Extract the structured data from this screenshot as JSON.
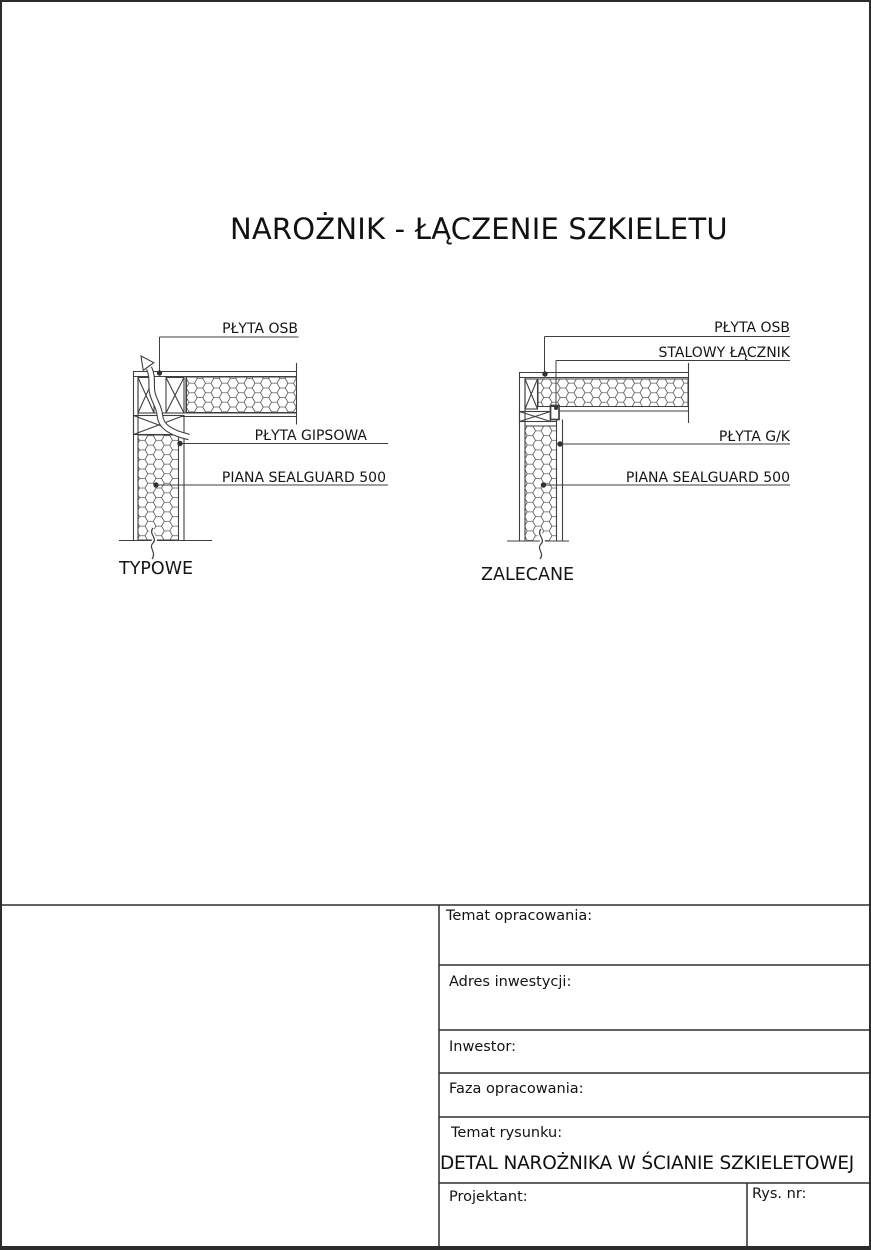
{
  "page": {
    "title": "NAROŻNIK - ŁĄCZENIE SZKIELETU"
  },
  "diagram_left": {
    "caption": "TYPOWE",
    "label_osb": "PŁYTA OSB",
    "label_gypsum": "PŁYTA GIPSOWA",
    "label_foam": "PIANA SEALGUARD 500"
  },
  "diagram_right": {
    "caption": "ZALECANE",
    "label_osb": "PŁYTA OSB",
    "label_connector": "STALOWY ŁĄCZNIK",
    "label_gk": "PŁYTA G/K",
    "label_foam": "PIANA SEALGUARD 500"
  },
  "title_block": {
    "temat_opracowania": "Temat opracowania:",
    "adres_inwestycji": "Adres inwestycji:",
    "inwestor": "Inwestor:",
    "faza_opracowania": "Faza opracowania:",
    "temat_rysunku": "Temat rysunku:",
    "drawing_title": "DETAL NAROŻNIKA W ŚCIANIE SZKIELETOWEJ",
    "projektant": "Projektant:",
    "rys_nr": "Rys. nr:"
  },
  "colors": {
    "background": "#ffffff",
    "line": "#3f3f3f",
    "text": "#161616"
  }
}
